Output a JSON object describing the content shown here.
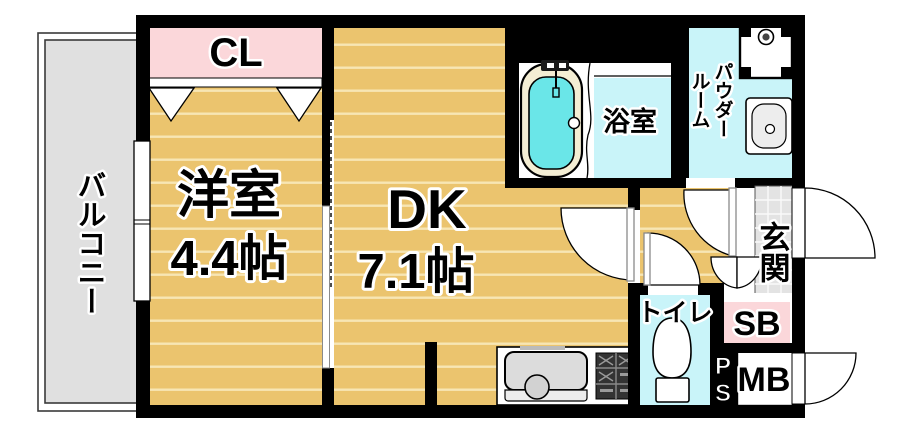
{
  "plan": {
    "type": "apartment-floor-plan",
    "balcony": {
      "label": "バルコニー"
    },
    "closet": {
      "label": "CL"
    },
    "western_room": {
      "label": "洋室",
      "size": "4.4帖"
    },
    "dining_kitchen": {
      "label": "DK",
      "size": "7.1帖"
    },
    "bathroom": {
      "label": "浴室"
    },
    "powder_room": {
      "label": "パウダールーム",
      "label_col_right": "パウダー",
      "label_col_left": "ルーム"
    },
    "entrance": {
      "label": "玄関"
    },
    "toilet": {
      "label": "トイレ"
    },
    "shoe_box": {
      "label": "SB"
    },
    "meter_box": {
      "label": "MB"
    },
    "pipe_space": {
      "label": "PS"
    },
    "colors": {
      "wall": "#000000",
      "floor": "#ebc46e",
      "floor_stripe": "#f7e6b4",
      "balcony_gray": "#e0e0e0",
      "closet_pink": "#fbd7da",
      "wet_area_cyan": "#c9f4f9",
      "tub_water": "#6ae6e8",
      "tub_rim": "#f4eed4",
      "entrance_tile": "#e3e3e3"
    },
    "fixtures": [
      "bathtub",
      "washing-machine-pan",
      "washbasin",
      "toilet-bowl",
      "kitchen-sink",
      "gas-stove",
      "closet-hangers",
      "entrance-door-swing",
      "meter-box-door-swing"
    ]
  }
}
